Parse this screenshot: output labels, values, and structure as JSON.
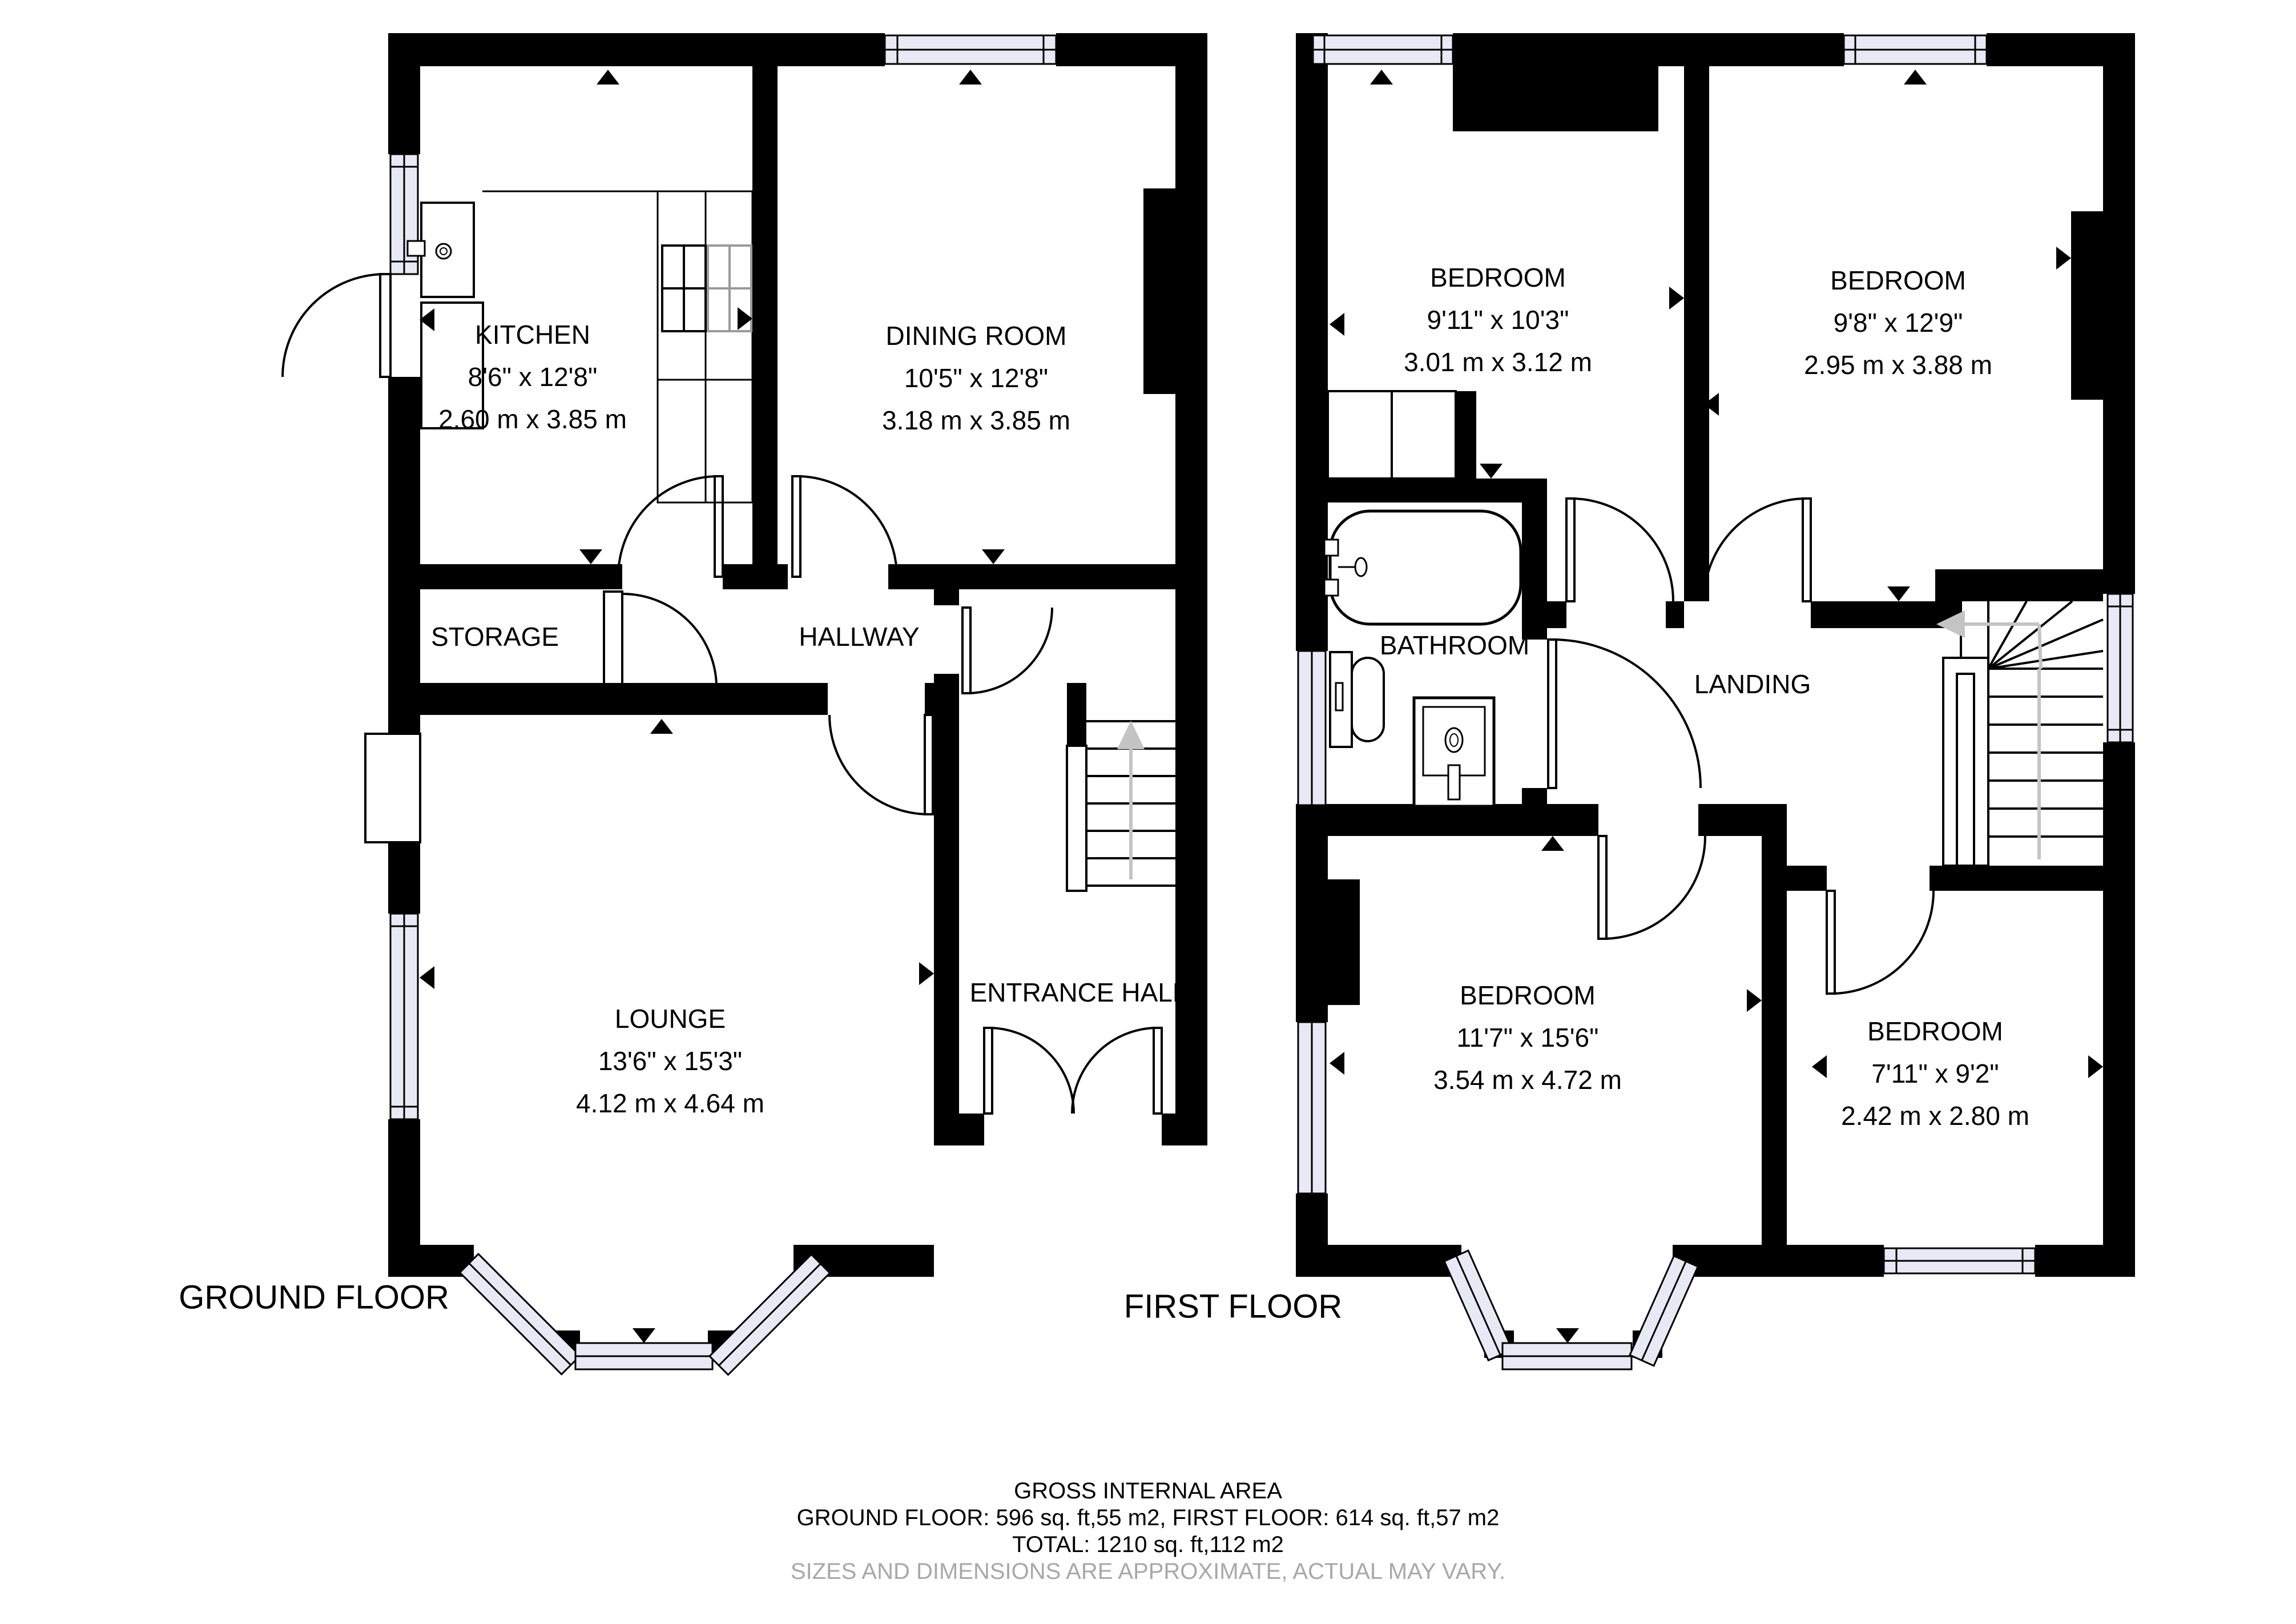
{
  "floors": {
    "ground": {
      "label": "GROUND FLOOR"
    },
    "first": {
      "label": "FIRST FLOOR"
    }
  },
  "rooms": {
    "kitchen": {
      "name": "KITCHEN",
      "imperial": "8'6\" x 12'8\"",
      "metric": "2.60 m x 3.85 m"
    },
    "dining_room": {
      "name": "DINING ROOM",
      "imperial": "10'5\" x 12'8\"",
      "metric": "3.18 m x 3.85 m"
    },
    "storage": {
      "name": "STORAGE"
    },
    "hallway": {
      "name": "HALLWAY"
    },
    "lounge": {
      "name": "LOUNGE",
      "imperial": "13'6\" x 15'3\"",
      "metric": "4.12 m x 4.64 m"
    },
    "entrance_hall": {
      "name": "ENTRANCE HALL"
    },
    "bedroom_1": {
      "name": "BEDROOM",
      "imperial": "9'11\" x 10'3\"",
      "metric": "3.01 m x 3.12 m"
    },
    "bedroom_2": {
      "name": "BEDROOM",
      "imperial": "9'8\" x 12'9\"",
      "metric": "2.95 m x 3.88 m"
    },
    "bathroom": {
      "name": "BATHROOM"
    },
    "landing": {
      "name": "LANDING"
    },
    "bedroom_3": {
      "name": "BEDROOM",
      "imperial": "11'7\" x 15'6\"",
      "metric": "3.54 m x 4.72 m"
    },
    "bedroom_4": {
      "name": "BEDROOM",
      "imperial": "7'11\" x 9'2\"",
      "metric": "2.42 m x 2.80 m"
    }
  },
  "footer": {
    "title": "GROSS INTERNAL AREA",
    "areas_line": "GROUND FLOOR: 596 sq. ft,55 m2, FIRST FLOOR: 614 sq. ft,57 m2",
    "total_line": "TOTAL: 1210 sq. ft,112 m2",
    "disclaimer": "SIZES AND DIMENSIONS ARE APPROXIMATE, ACTUAL MAY VARY."
  },
  "colors": {
    "wall": "#000000",
    "window_fill": "#e9e9f6",
    "stair_arrow": "#c4c4c4",
    "stove_alt": "#9a9a9a",
    "disclaimer_text": "#a8a8a8"
  }
}
